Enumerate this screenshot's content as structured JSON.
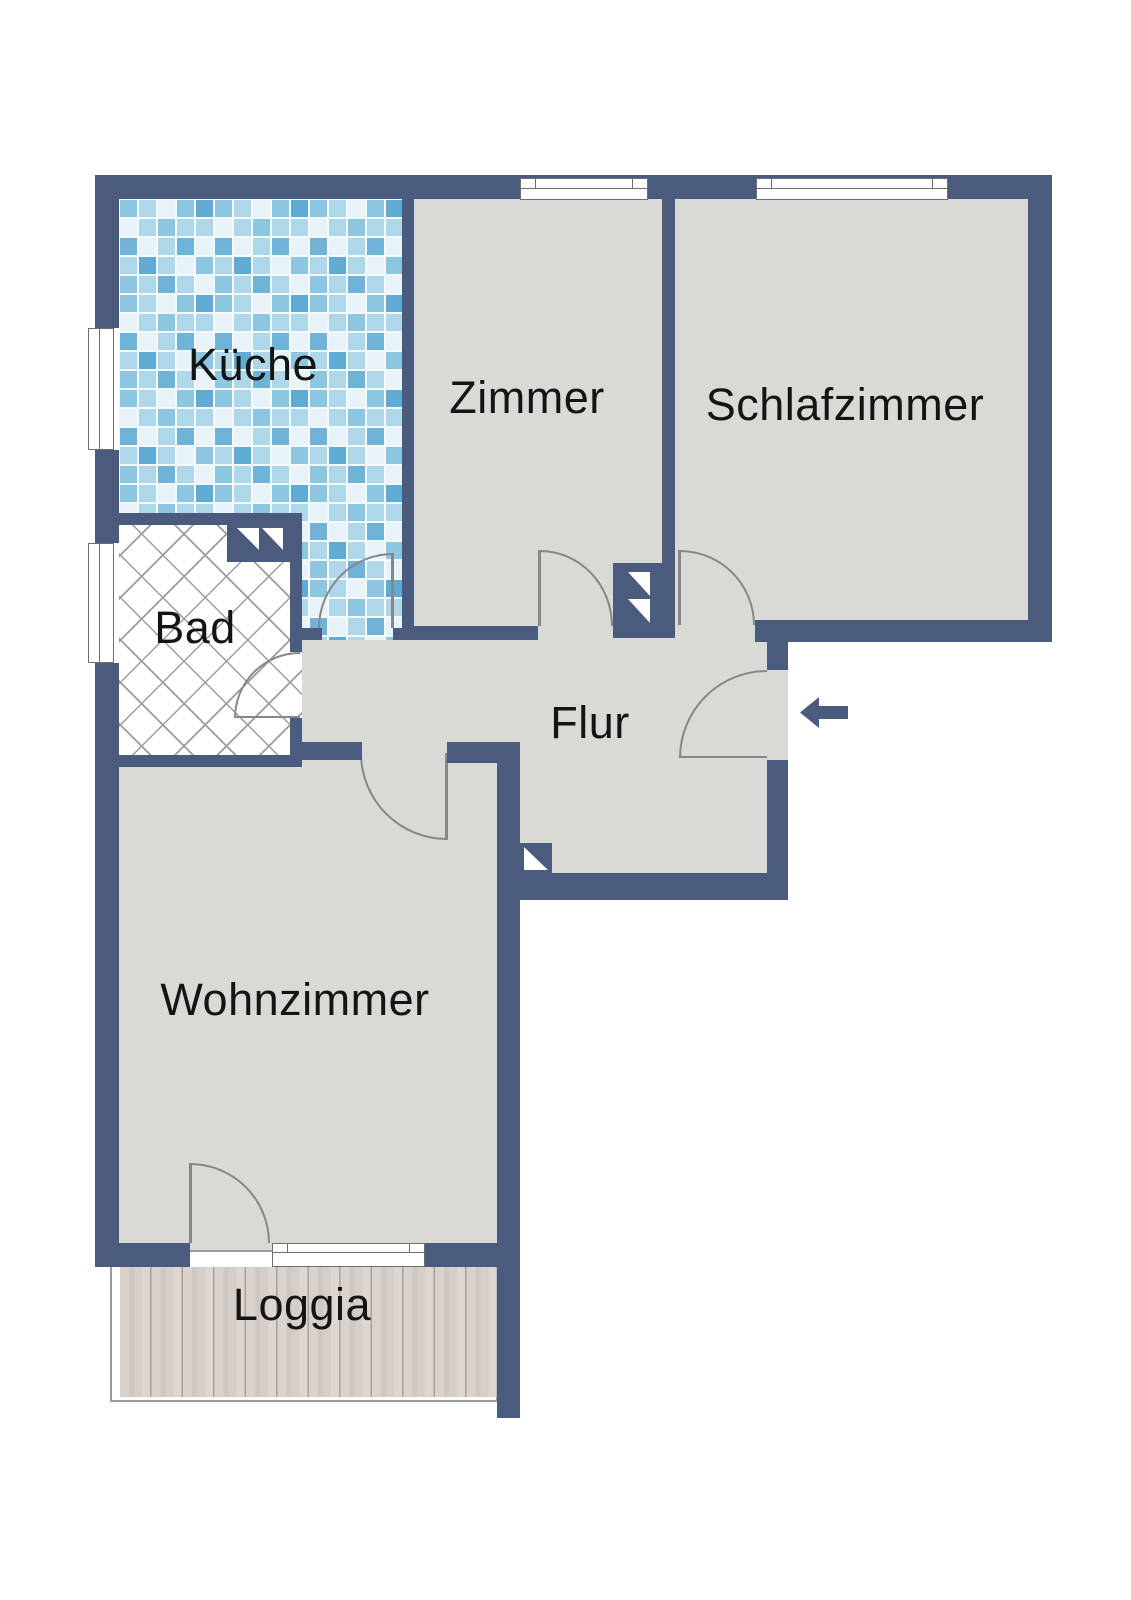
{
  "rooms": {
    "kueche": {
      "label": "Küche",
      "floor_texture": "blue-mosaic-tiles"
    },
    "zimmer": {
      "label": "Zimmer",
      "floor_texture": "plain-gray"
    },
    "schlafzimmer": {
      "label": "Schlafzimmer",
      "floor_texture": "plain-gray"
    },
    "bad": {
      "label": "Bad",
      "floor_texture": "diagonal-crosshatch"
    },
    "flur": {
      "label": "Flur",
      "floor_texture": "plain-gray"
    },
    "wohnzimmer": {
      "label": "Wohnzimmer",
      "floor_texture": "plain-gray"
    },
    "loggia": {
      "label": "Loggia",
      "floor_texture": "wood-planks"
    }
  },
  "entrance": {
    "symbol": "left-arrow"
  },
  "colors": {
    "wall": "#4a5b7d",
    "floor": "#d9d9d6",
    "tile_light": "#e8f3f9",
    "tile_mid": "#8cc6e0",
    "tile_dark": "#5fabd3",
    "wood": "#d5cdc7",
    "door": "#878787"
  }
}
